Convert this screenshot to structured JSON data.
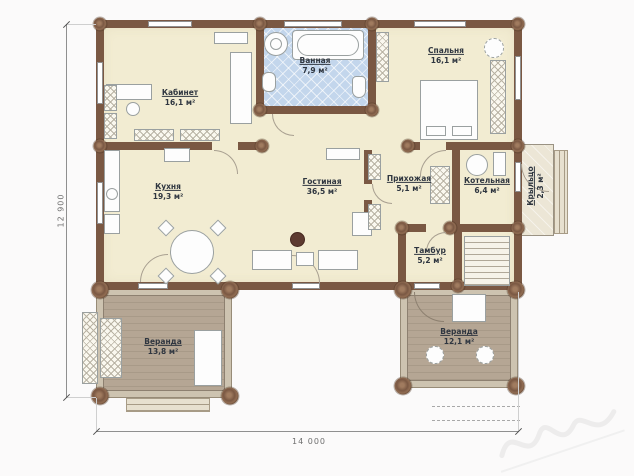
{
  "plan": {
    "dimensions": {
      "width_label": "14 000",
      "height_label": "12 900"
    },
    "rooms": [
      {
        "name": "Кабинет",
        "area": "16,1 м²"
      },
      {
        "name": "Ванная",
        "area": "7,9 м²"
      },
      {
        "name": "Спальня",
        "area": "16,1 м²"
      },
      {
        "name": "Кухня",
        "area": "19,3 м²"
      },
      {
        "name": "Гостиная",
        "area": "36,5 м²"
      },
      {
        "name": "Прихожая",
        "area": "5,1 м²"
      },
      {
        "name": "Котельная",
        "area": "6,4 м²"
      },
      {
        "name": "Крыльцо",
        "area": "2,3 м²"
      },
      {
        "name": "Тамбур",
        "area": "5,2 м²"
      },
      {
        "name": "Веранда",
        "area": "13,8 м²"
      },
      {
        "name": "Веранда",
        "area": "12,1 м²"
      }
    ],
    "colors": {
      "wall": "#7a5843",
      "floor": "#f2ecd2",
      "bathroom_floor": "#c3d6ec",
      "veranda_floor": "#b5a694"
    }
  }
}
